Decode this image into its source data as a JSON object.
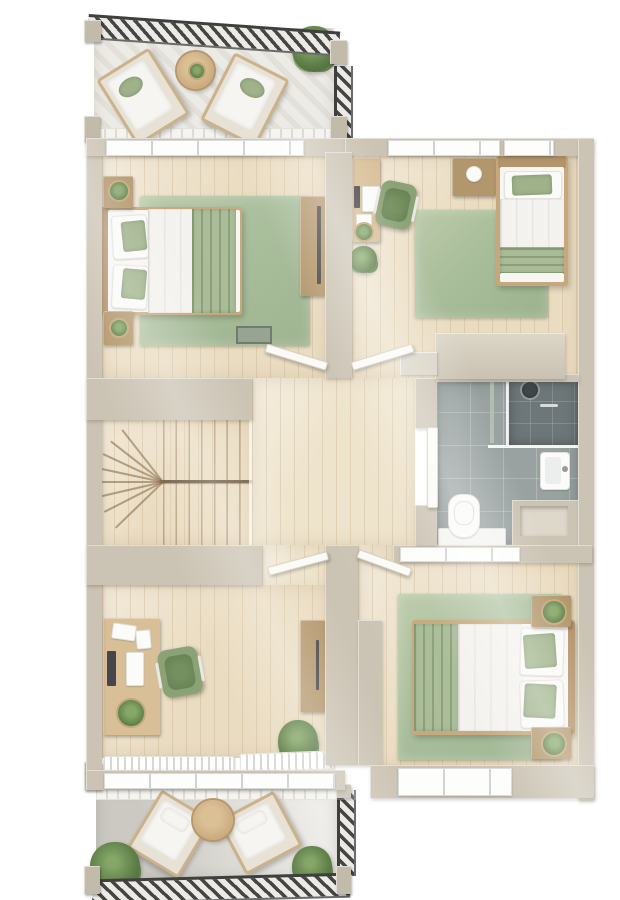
{
  "scene": {
    "kind": "architectural-floor-plan-3d-render",
    "view": "top-down",
    "level": "upper-floor",
    "background": "#ffffff",
    "visible_text": "none"
  },
  "palette": {
    "wall": "#cbc3b3",
    "wall_light": "#ddd7c9",
    "wall_shadow": "#b5ad9c",
    "floor_wood": "#eadcc1",
    "hall_wood": "#eee3cb",
    "wood_line": "#c9a87e",
    "rug": "#a8bd9a",
    "rug_light": "#bccbaa",
    "blanket": "#a9bc97",
    "pillow_green": "#9fb28a",
    "duvet": "#f3f2ee",
    "mattress": "#f7f6f3",
    "bed_wood": "#c6a87c",
    "stand_wood": "#b3976c",
    "desk_wood": "#d8bf97",
    "tile": "#99a2a1",
    "tile_dark": "#6d7779",
    "balcony_n": "#edebe6",
    "balcony_s": "#dedcd7",
    "rail_dark": "#454543",
    "rail_light": "#eceae6",
    "plant": "#5f8049",
    "plant_dark": "#42603a",
    "plant_light": "#86a768",
    "door_white": "#fbfaf6",
    "window_white": "#fdfdfc"
  },
  "rooms": [
    {
      "name": "balcony-north",
      "floor": "light-concrete",
      "items": [
        "lounge-chair",
        "lounge-chair",
        "round-side-table",
        "table-plant",
        "potted-plant",
        "hatched-railing",
        "corner-posts"
      ]
    },
    {
      "name": "bedroom-master",
      "floor": "wood-plank",
      "items": [
        "double-bed-green-white",
        "nightstand-with-plant",
        "nightstand-with-plant",
        "green-area-rug",
        "sideboard-with-tv",
        "wall-art",
        "window-band"
      ]
    },
    {
      "name": "bedroom-single",
      "floor": "wood-plank",
      "items": [
        "single-bed-green-white",
        "wall-desk-with-laptop",
        "desk-chair-green",
        "nightstand",
        "floor-plant",
        "green-area-rug",
        "built-in-closet",
        "window-band"
      ]
    },
    {
      "name": "hallway-landing",
      "floor": "wood-plank",
      "items": [
        "door-to-master",
        "door-to-single-bedroom",
        "door-to-office",
        "door-to-south-bedroom",
        "door-to-bathroom"
      ]
    },
    {
      "name": "staircase",
      "floor": "wood-plank",
      "items": [
        "winder-stairs",
        "flight-divider"
      ]
    },
    {
      "name": "bathroom",
      "floor": "gray-tile",
      "items": [
        "walk-in-shower",
        "shower-head",
        "glass-screen",
        "washbasin",
        "toilet",
        "bath-mat",
        "storage-niche"
      ]
    },
    {
      "name": "office",
      "floor": "wood-plank",
      "items": [
        "desk-with-laptop",
        "papers",
        "desk-plant",
        "desk-chair-green",
        "tall-cabinet",
        "floor-plant",
        "window-blinds",
        "window-band"
      ]
    },
    {
      "name": "bedroom-south",
      "floor": "wood-plank",
      "items": [
        "double-bed-green-white",
        "nightstand-with-plant",
        "nightstand-with-plant",
        "green-area-rug",
        "window-band"
      ]
    },
    {
      "name": "balcony-south",
      "floor": "gray-concrete",
      "items": [
        "armchair",
        "armchair",
        "round-table",
        "potted-plant",
        "potted-plant",
        "hatched-railing",
        "corner-posts"
      ]
    }
  ]
}
